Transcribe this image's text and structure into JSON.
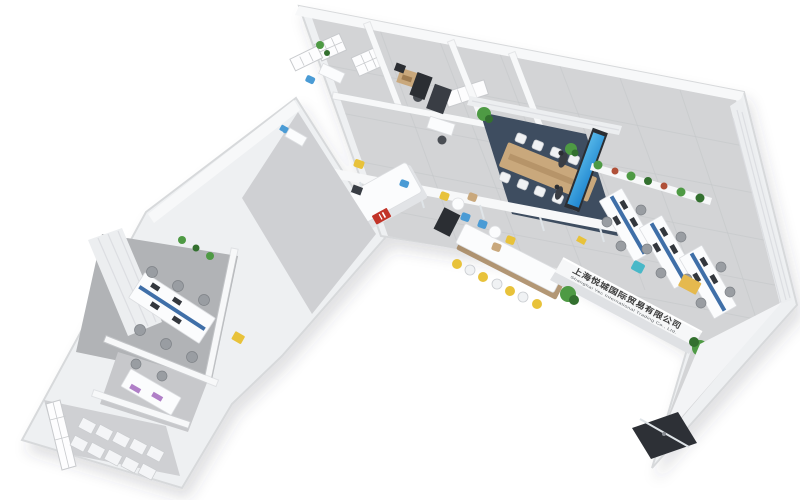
{
  "scene": {
    "type": "3d-isometric-office-floorplan-render",
    "background": "#ffffff"
  },
  "company_sign": {
    "chinese": "上海悦城国际贸易有限公司",
    "english": "Shanghai Yec International Trading Co., Ltd."
  },
  "colors": {
    "background": "#ffffff",
    "wall_fill": "#eef0f2",
    "wall_stroke": "#d7d9db",
    "floor_tile": "#d3d4d6",
    "corridor_tile": "#cfd0d3",
    "carpet_navy": "#3e4d60",
    "carpet_gray": "#b1b3b6",
    "curtain": "#eceef0",
    "desk_white": "#fbfcfd",
    "partition_blue": "#3f6fa8",
    "chair_gray": "#999da2",
    "chair_white": "#f0f2f4",
    "stool_yellow": "#e8c23a",
    "accent_blue": "#4a9bd5",
    "accent_teal": "#49b8c8",
    "wood": "#c9a87c",
    "plant_green": "#4e9a44",
    "pot_red": "#b05038",
    "screen_blue": "#1f85cf",
    "logo_red": "#c23429",
    "entrance_dark": "#2d3036",
    "sign_text": "#3b3b3b",
    "cabinet_yellow": "#e5b94e",
    "purple": "#b07fc7"
  },
  "areas": [
    "private-office",
    "manager-office",
    "server-storage-room",
    "conference-room",
    "reception",
    "bar-cafe",
    "open-office",
    "sign-wall",
    "entrance-lobby",
    "west-office-1",
    "west-office-2",
    "archive-storage-room"
  ],
  "furniture_counts": {
    "bar_stools": 7,
    "conference_chairs": 10,
    "open_office_desk_clusters": 3,
    "west_office_workstations": 4,
    "archive_cabinets": 10
  }
}
